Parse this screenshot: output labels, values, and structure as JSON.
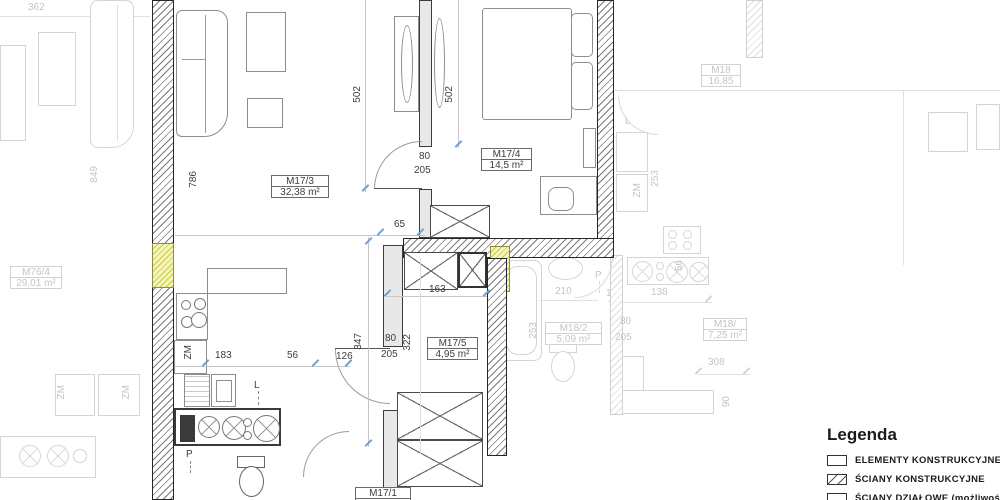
{
  "rooms": {
    "m17_3": {
      "id": "M17/3",
      "area": "32,38 m²"
    },
    "m17_4": {
      "id": "M17/4",
      "area": "14,5 m²"
    },
    "m17_5": {
      "id": "M17/5",
      "area": "4,95 m²"
    },
    "m17_1": {
      "id": "M17/1",
      "area": ""
    },
    "m76_4": {
      "id": "M76/4",
      "area": "29,01 m²"
    },
    "m18": {
      "id": "M18",
      "area": "16,85"
    },
    "m18_2": {
      "id": "M18/2",
      "area": "5,09 m²"
    },
    "m18_x": {
      "id": "M18/",
      "area": "7,25 m²"
    }
  },
  "dims": {
    "d362": "362",
    "d849": "849",
    "d786": "786",
    "d502a": "502",
    "d502b": "502",
    "d80a": "80",
    "d205a": "205",
    "d65": "65",
    "d163": "163",
    "d347": "347",
    "d126": "126",
    "d80b": "80",
    "d205b": "205",
    "d322": "322",
    "d183": "183",
    "d56a": "56",
    "d210": "210",
    "d253a": "253",
    "d253b": "253",
    "d12": "12",
    "d138": "138",
    "d56b": "56",
    "d80c": "80",
    "d205c": "205",
    "d308": "308",
    "d90": "90"
  },
  "marks": {
    "zm1": "ZM",
    "zm2": "ZM",
    "zm3": "ZM",
    "zm4": "ZM",
    "l1": "L",
    "l2": "L",
    "p1": "P",
    "p2": "P"
  },
  "legend": {
    "title": "Legenda",
    "items": [
      {
        "label": "ELEMENTY KONSTRUKCYJNE"
      },
      {
        "label": "ŚCIANY KONSTRUKCYJNE"
      },
      {
        "label": "ŚCIANY DZIAŁOWE (możliwość"
      }
    ]
  },
  "colors": {
    "structural_element": "#e9e96a",
    "wall_line": "#262626",
    "faded": "#c1c5c9",
    "dim_tick": "#69a1d8"
  }
}
